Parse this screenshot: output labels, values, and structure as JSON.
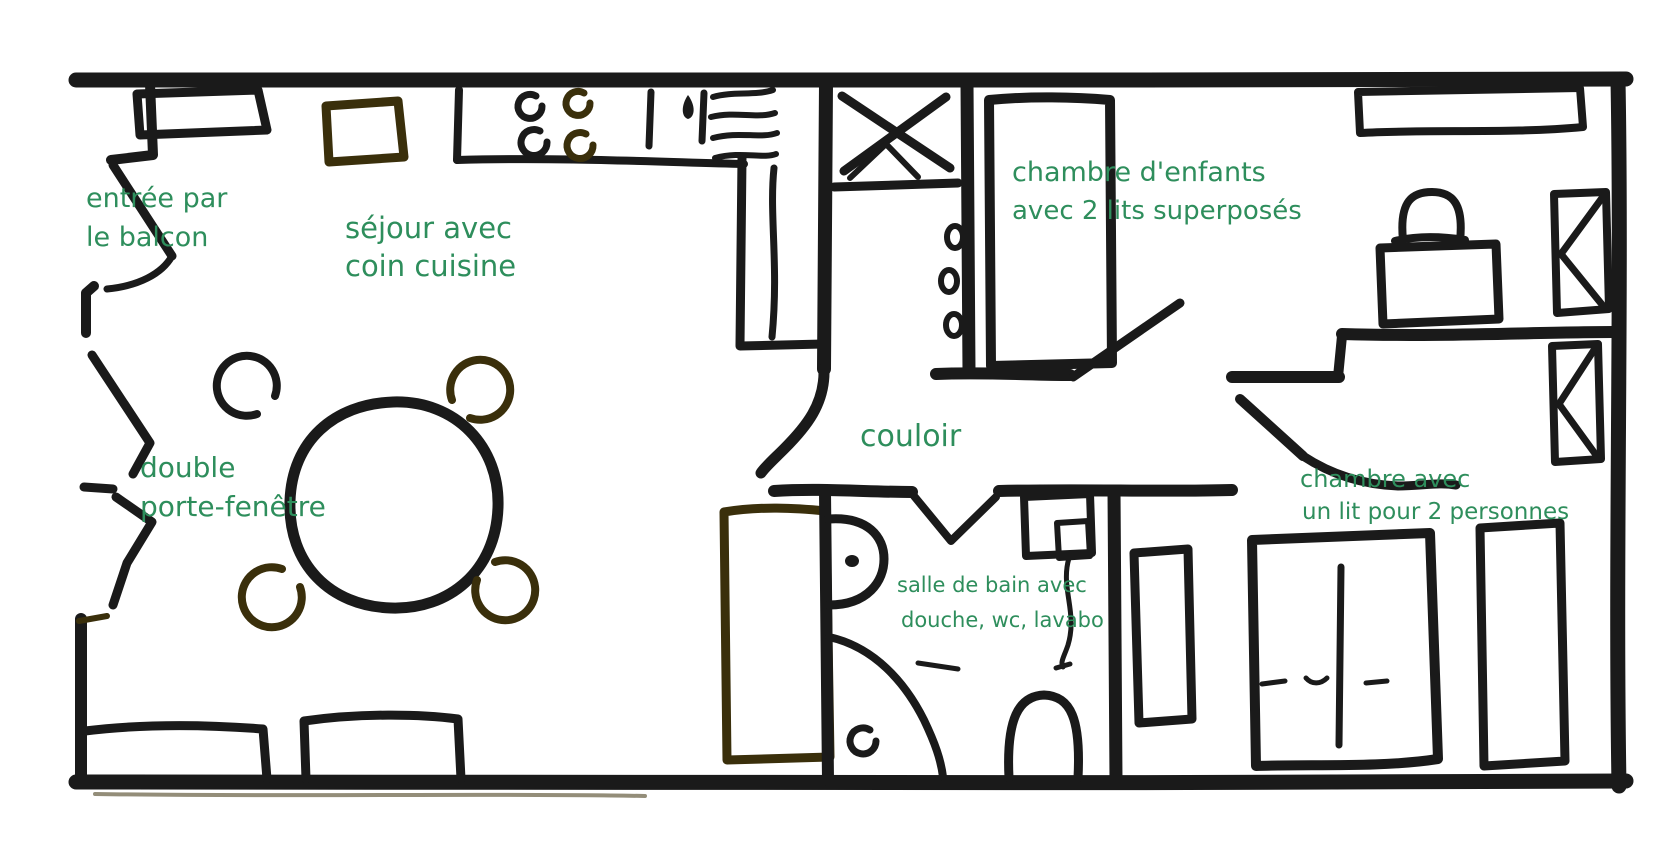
{
  "colors": {
    "wall_ink": "#1a1a1a",
    "olive_ink": "#3a2f0b",
    "label_green": "#2e8e5c",
    "paper": "#ffffff"
  },
  "labels": {
    "entree": {
      "line1": "entrée par",
      "line2": "le balcon"
    },
    "sejour": {
      "line1": "séjour avec",
      "line2": "coin cuisine"
    },
    "porte_fenetre": {
      "line1": "double",
      "line2": "porte-fenêtre"
    },
    "couloir": {
      "line1": "couloir"
    },
    "chambre_enfants": {
      "line1": "chambre d'enfants",
      "line2": "avec 2 lits superposés"
    },
    "chambre_double": {
      "line1": "chambre avec",
      "line2": "un lit pour 2 personnes"
    },
    "salle_de_bain": {
      "line1": "salle de bain avec",
      "line2": "douche, wc, lavabo"
    }
  }
}
